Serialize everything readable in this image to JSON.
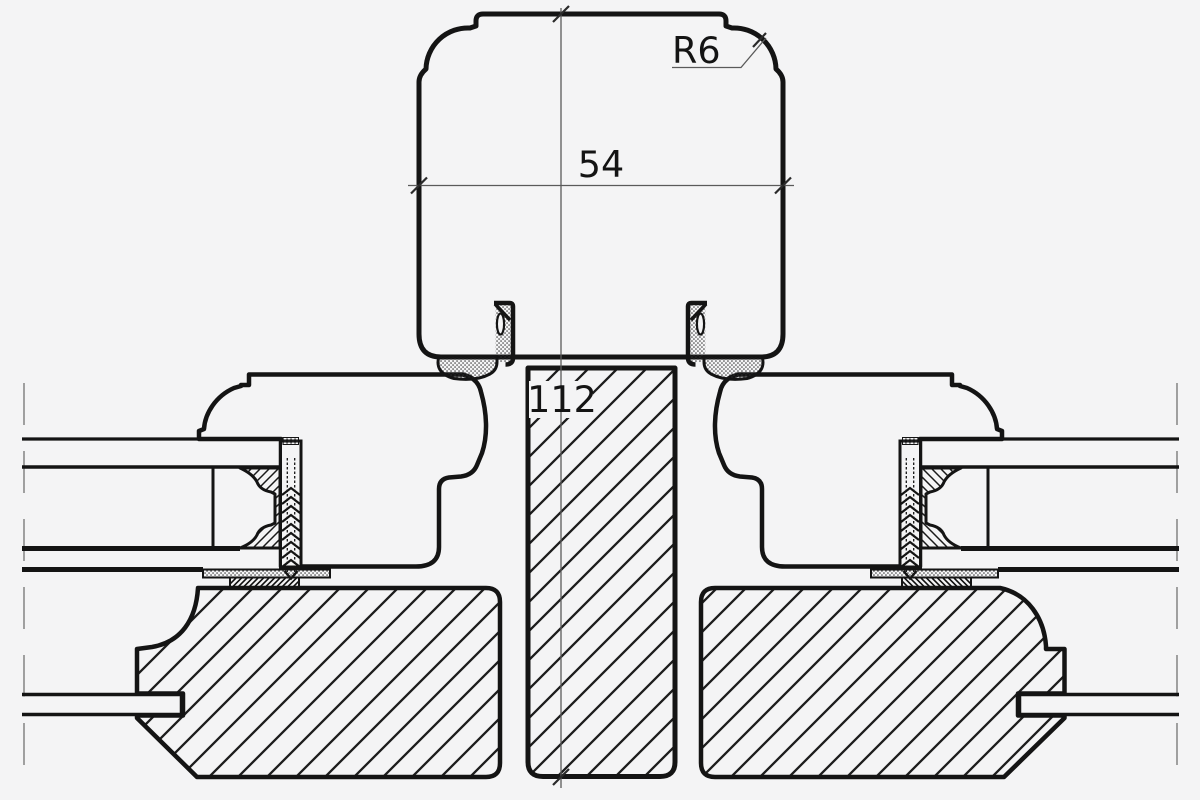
{
  "drawing": {
    "description": "Technical cross-section detail of a timber window mullion joint: decorative cover cap over a hatched center post, flanked by mirrored sash frames with insulated glazing units, fixing screws, gaskets and hatched bottom frame blocks",
    "background_color": "#f4f4f5",
    "line_color": "#141414",
    "dim_line_color": "#5a5a5a",
    "annotations": {
      "radius_label": "R6",
      "cap_width_label": "54",
      "overall_height_label": "112"
    }
  }
}
